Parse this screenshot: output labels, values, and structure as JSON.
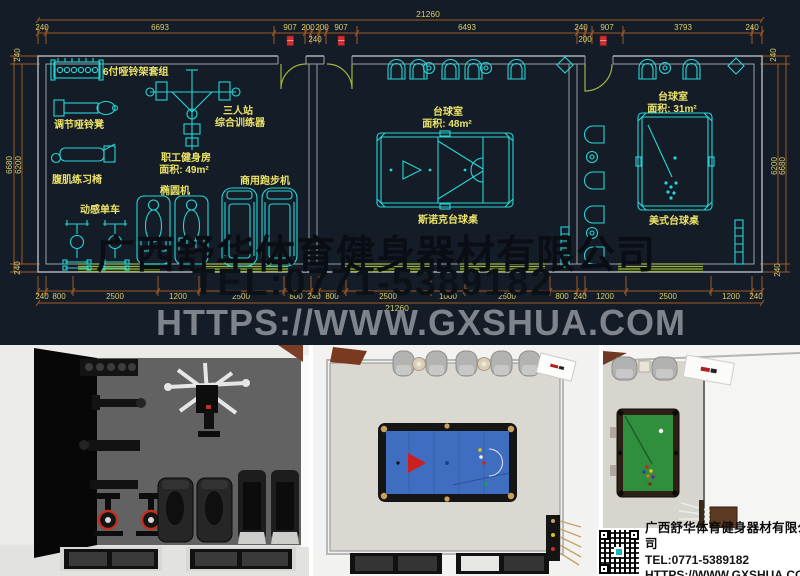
{
  "plan": {
    "top": {
      "total": "21260",
      "row": [
        "240",
        "6693",
        "907",
        "200",
        "200",
        "907",
        "6493",
        "240",
        "907",
        "3793",
        "240"
      ],
      "sub": [
        "240",
        "200"
      ]
    },
    "bottom": {
      "total": "21260",
      "row": [
        "240",
        "800",
        "2500",
        "1200",
        "2500",
        "800",
        "240",
        "800",
        "2500",
        "1000",
        "2500",
        "800",
        "240",
        "1200",
        "2500",
        "1200",
        "240"
      ]
    },
    "left": [
      "240",
      "6680",
      "6200",
      "240"
    ],
    "right": [
      "240",
      "6200",
      "6680",
      "240"
    ],
    "rooms": {
      "gym": {
        "title": "职工健身房",
        "area": "面积: 49m²",
        "labels": {
          "dumbbell_rack": "6付哑铃架套组",
          "adjustable_bench": "调节哑铃凳",
          "trainer_line1": "三人站",
          "trainer_line2": "综合训练器",
          "ab_chair": "腹肌练习椅",
          "treadmill": "商用跑步机",
          "elliptical": "椭圆机",
          "spin_bike": "动感单车"
        }
      },
      "billiard_large": {
        "title": "台球室",
        "area": "面积: 48m²",
        "table_label": "斯诺克台球桌"
      },
      "billiard_small": {
        "title": "台球室",
        "area": "面积: 31m²",
        "table_label": "美式台球桌"
      }
    }
  },
  "watermark": {
    "company": "广西舒华体育健身器材有限公司",
    "tel": "TEL:0771-5389182",
    "website": "HTTPS://WWW.GXSHUA.COM"
  },
  "footer": {
    "company": "广西舒华体育健身器材有限公司",
    "tel": "TEL:0771-5389182",
    "website": "HTTPS://WWW.GXSHUA.COM"
  },
  "colors": {
    "plan_bg": "#141c27",
    "cad_cyan": "#25d7d6",
    "label_yellow": "#ece367",
    "dim_brown": "#a05a24",
    "window_green": "#9cb43c",
    "door_tag_red": "#cf2f2f",
    "table_blue": "#3f6ec0",
    "table_green": "#2f8f3d"
  }
}
